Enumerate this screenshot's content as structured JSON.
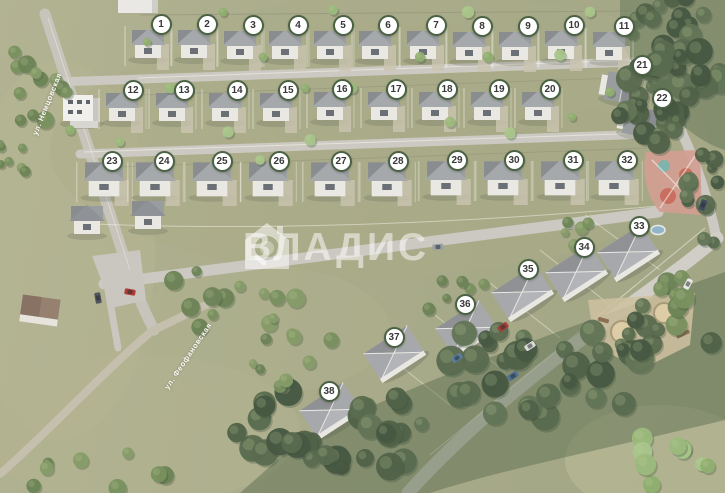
{
  "map": {
    "watermark": {
      "text": "ВЛАДИС",
      "logo": "house-magnifier-icon"
    },
    "streets": [
      {
        "name": "ул. Немцовская",
        "x": 47,
        "y": 104,
        "angle": -68
      },
      {
        "name": "ул. Феофановская",
        "x": 188,
        "y": 356,
        "angle": -56
      }
    ],
    "legend": {
      "marker_style": "numbered-circle",
      "marker_bg": "#ffffff",
      "marker_border": "#4a6144",
      "marker_text_color": "#383838"
    },
    "markers": [
      {
        "n": "1",
        "x": 161,
        "y": 24,
        "hx": 148,
        "hy": 50,
        "hv": "a"
      },
      {
        "n": "2",
        "x": 207,
        "y": 24,
        "hx": 194,
        "hy": 50,
        "hv": "a"
      },
      {
        "n": "3",
        "x": 253,
        "y": 25,
        "hx": 240,
        "hy": 51,
        "hv": "a"
      },
      {
        "n": "4",
        "x": 298,
        "y": 25,
        "hx": 285,
        "hy": 51,
        "hv": "a"
      },
      {
        "n": "5",
        "x": 343,
        "y": 25,
        "hx": 330,
        "hy": 51,
        "hv": "a"
      },
      {
        "n": "6",
        "x": 388,
        "y": 25,
        "hx": 375,
        "hy": 51,
        "hv": "a"
      },
      {
        "n": "7",
        "x": 436,
        "y": 25,
        "hx": 423,
        "hy": 51,
        "hv": "a"
      },
      {
        "n": "8",
        "x": 482,
        "y": 26,
        "hx": 469,
        "hy": 52,
        "hv": "a"
      },
      {
        "n": "9",
        "x": 528,
        "y": 26,
        "hx": 515,
        "hy": 52,
        "hv": "a"
      },
      {
        "n": "10",
        "x": 574,
        "y": 25,
        "hx": 561,
        "hy": 51,
        "hv": "a"
      },
      {
        "n": "11",
        "x": 624,
        "y": 26,
        "hx": 609,
        "hy": 52,
        "hv": "a"
      },
      {
        "n": "12",
        "x": 133,
        "y": 90,
        "hx": 122,
        "hy": 113,
        "hv": "a"
      },
      {
        "n": "13",
        "x": 184,
        "y": 90,
        "hx": 172,
        "hy": 113,
        "hv": "a"
      },
      {
        "n": "14",
        "x": 237,
        "y": 90,
        "hx": 225,
        "hy": 113,
        "hv": "a"
      },
      {
        "n": "15",
        "x": 288,
        "y": 90,
        "hx": 276,
        "hy": 113,
        "hv": "a"
      },
      {
        "n": "16",
        "x": 342,
        "y": 89,
        "hx": 330,
        "hy": 112,
        "hv": "a"
      },
      {
        "n": "17",
        "x": 396,
        "y": 89,
        "hx": 384,
        "hy": 112,
        "hv": "a"
      },
      {
        "n": "18",
        "x": 447,
        "y": 89,
        "hx": 435,
        "hy": 112,
        "hv": "a"
      },
      {
        "n": "19",
        "x": 499,
        "y": 89,
        "hx": 487,
        "hy": 112,
        "hv": "a"
      },
      {
        "n": "20",
        "x": 550,
        "y": 89,
        "hx": 538,
        "hy": 112,
        "hv": "a"
      },
      {
        "n": "21",
        "x": 642,
        "y": 65,
        "hx": 622,
        "hy": 88,
        "hv": "s"
      },
      {
        "n": "22",
        "x": 662,
        "y": 98,
        "hx": 640,
        "hy": 122,
        "hv": "s"
      },
      {
        "n": "23",
        "x": 112,
        "y": 161,
        "hx": 104,
        "hy": 186,
        "hv": "b"
      },
      {
        "n": "24",
        "x": 164,
        "y": 161,
        "hx": 155,
        "hy": 186,
        "hv": "b"
      },
      {
        "n": "25",
        "x": 222,
        "y": 161,
        "hx": 212,
        "hy": 186,
        "hv": "b"
      },
      {
        "n": "26",
        "x": 279,
        "y": 161,
        "hx": 268,
        "hy": 186,
        "hv": "b"
      },
      {
        "n": "27",
        "x": 341,
        "y": 161,
        "hx": 330,
        "hy": 186,
        "hv": "b"
      },
      {
        "n": "28",
        "x": 398,
        "y": 161,
        "hx": 387,
        "hy": 186,
        "hv": "b"
      },
      {
        "n": "29",
        "x": 457,
        "y": 160,
        "hx": 446,
        "hy": 185,
        "hv": "b"
      },
      {
        "n": "30",
        "x": 514,
        "y": 160,
        "hx": 503,
        "hy": 185,
        "hv": "b"
      },
      {
        "n": "31",
        "x": 573,
        "y": 160,
        "hx": 560,
        "hy": 185,
        "hv": "b"
      },
      {
        "n": "32",
        "x": 627,
        "y": 160,
        "hx": 614,
        "hy": 185,
        "hv": "b"
      },
      {
        "n": "33",
        "x": 639,
        "y": 226,
        "hx": 628,
        "hy": 252,
        "hv": "d"
      },
      {
        "n": "34",
        "x": 584,
        "y": 247,
        "hx": 576,
        "hy": 272,
        "hv": "d"
      },
      {
        "n": "35",
        "x": 528,
        "y": 269,
        "hx": 522,
        "hy": 292,
        "hv": "d"
      },
      {
        "n": "36",
        "x": 465,
        "y": 304,
        "hx": 466,
        "hy": 328,
        "hv": "d"
      },
      {
        "n": "37",
        "x": 394,
        "y": 337,
        "hx": 394,
        "hy": 353,
        "hv": "d"
      },
      {
        "n": "38",
        "x": 329,
        "y": 391,
        "hx": 330,
        "hy": 410,
        "hv": "d"
      }
    ],
    "amenities": [
      {
        "name": "playground",
        "x": 672,
        "y": 182
      },
      {
        "name": "park-rest-area",
        "x": 638,
        "y": 330
      }
    ]
  }
}
